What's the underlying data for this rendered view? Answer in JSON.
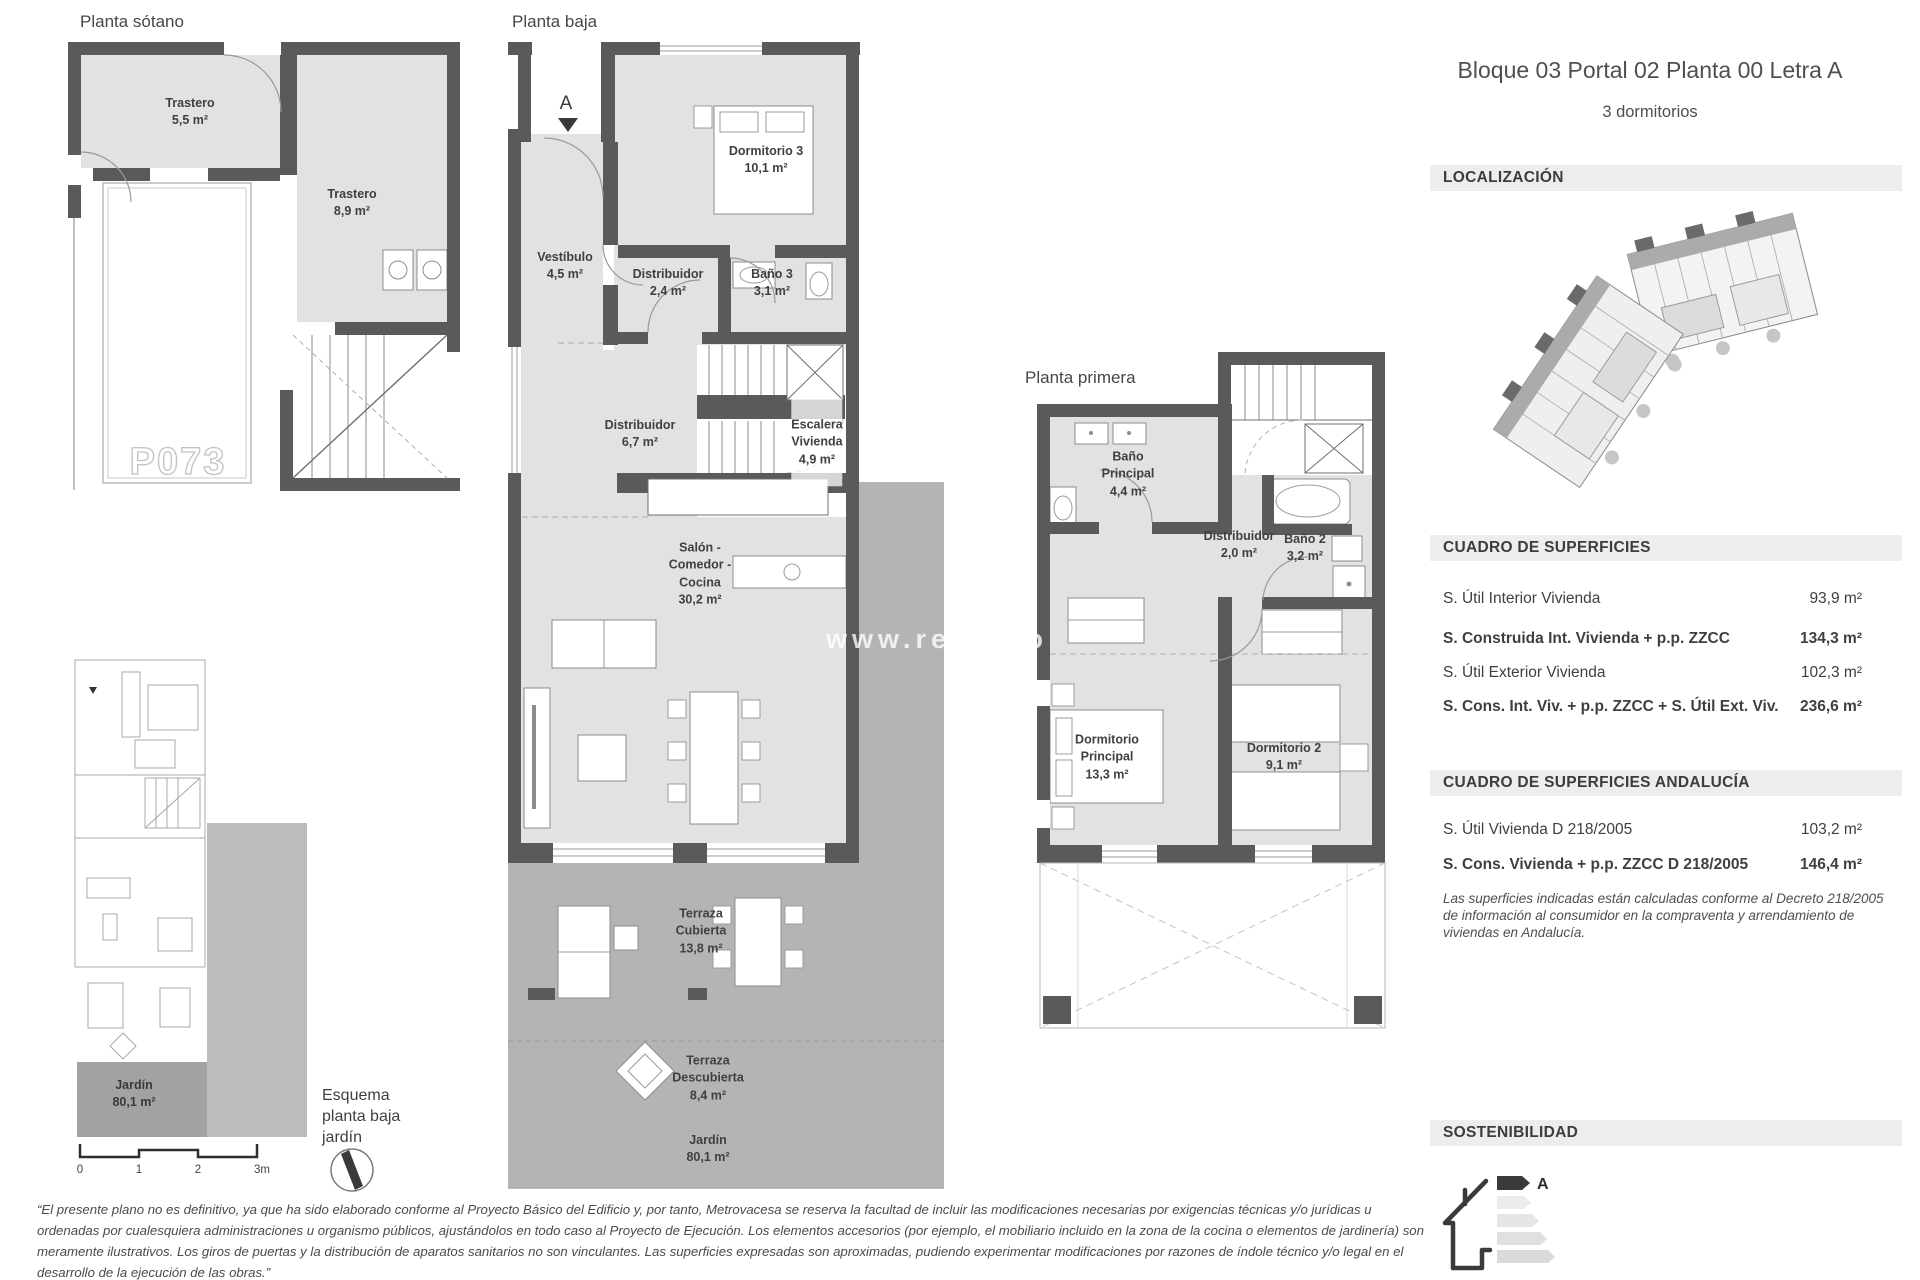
{
  "header": {
    "title": "Bloque 03 Portal 02 Planta 00 Letra A",
    "subtitle": "3 dormitorios"
  },
  "sections": {
    "localizacion": "LOCALIZACIÓN",
    "superficies": "CUADRO DE SUPERFICIES",
    "superficies_andalucia": "CUADRO DE SUPERFICIES ANDALUCÍA",
    "sostenibilidad": "SOSTENIBILIDAD"
  },
  "surfaces": {
    "rows": [
      {
        "label": "S. Útil Interior Vivienda",
        "value": "93,9 m²"
      },
      {
        "label": "S. Construida Int. Vivienda + p.p. ZZCC",
        "value": "134,3 m²"
      },
      {
        "label": "S. Útil Exterior Vivienda",
        "value": "102,3 m²"
      },
      {
        "label": "S. Cons. Int. Viv. + p.p. ZZCC + S. Útil Ext. Viv.",
        "value": "236,6 m²"
      }
    ]
  },
  "surfaces_andalucia": {
    "rows": [
      {
        "label": "S. Útil Vivienda D 218/2005",
        "value": "103,2 m²"
      },
      {
        "label": "S. Cons. Vivienda + p.p. ZZCC D 218/2005",
        "value": "146,4 m²"
      }
    ],
    "note": "Las superficies indicadas están calculadas conforme al Decreto 218/2005 de información al consumidor en la compraventa y arrendamiento de viviendas en Andalucía."
  },
  "energy": {
    "rating": "A"
  },
  "plans": {
    "sotano": {
      "title": "Planta sótano",
      "parking_label": "P073",
      "rooms": [
        {
          "name": "Trastero",
          "area": "5,5 m²"
        },
        {
          "name": "Trastero",
          "area": "8,9 m²"
        }
      ]
    },
    "baja": {
      "title": "Planta baja",
      "section_marker": "A",
      "rooms": [
        {
          "name": "Vestíbulo",
          "area": "4,5 m²"
        },
        {
          "name": "Distribuidor",
          "area": "2,4 m²"
        },
        {
          "name": "Baño 3",
          "area": "3,1 m²"
        },
        {
          "name": "Dormitorio 3",
          "area": "10,1 m²"
        },
        {
          "name": "Distribuidor",
          "area": "6,7 m²"
        },
        {
          "name": "Escalera\nVivienda",
          "area": "4,9 m²"
        },
        {
          "name": "Salón -\nComedor -\nCocina",
          "area": "30,2 m²"
        },
        {
          "name": "Terraza\nCubierta",
          "area": "13,8 m²"
        },
        {
          "name": "Terraza\nDescubierta",
          "area": "8,4 m²"
        },
        {
          "name": "Jardín",
          "area": "80,1 m²"
        }
      ]
    },
    "primera": {
      "title": "Planta primera",
      "rooms": [
        {
          "name": "Baño\nPrincipal",
          "area": "4,4 m²"
        },
        {
          "name": "Distribuidor",
          "area": "2,0 m²"
        },
        {
          "name": "Baño 2",
          "area": "3,2 m²"
        },
        {
          "name": "Dormitorio\nPrincipal",
          "area": "13,3 m²"
        },
        {
          "name": "Dormitorio 2",
          "area": "9,1 m²"
        }
      ]
    }
  },
  "esquema": {
    "label": "Esquema planta baja jardín",
    "garden": {
      "name": "Jardín",
      "area": "80,1 m²"
    },
    "scale_ticks": [
      "0",
      "1",
      "2",
      "3m"
    ]
  },
  "watermark": "www.redpiso",
  "disclaimer": "“El presente plano no es definitivo, ya que ha sido elaborado conforme al Proyecto Básico del Edificio y, por tanto, Metrovacesa se reserva la facultad de incluir las modificaciones necesarias por exigencias técnicas y/o jurídicas u ordenadas por cualesquiera administraciones u organismo públicos, ajustándolos en todo caso al Proyecto de Ejecución. Los elementos accesorios (por ejemplo, el mobiliario incluido en la zona de la cocina o elementos de jardinería) son meramente ilustrativos. Los giros de puertas y la distribución de aparatos sanitarios no son vinculantes. Las superficies expresadas son aproximadas, pudiendo experimentar modificaciones por razones de índole técnico y/o legal en el desarrollo de la ejecución de las obras.”"
}
